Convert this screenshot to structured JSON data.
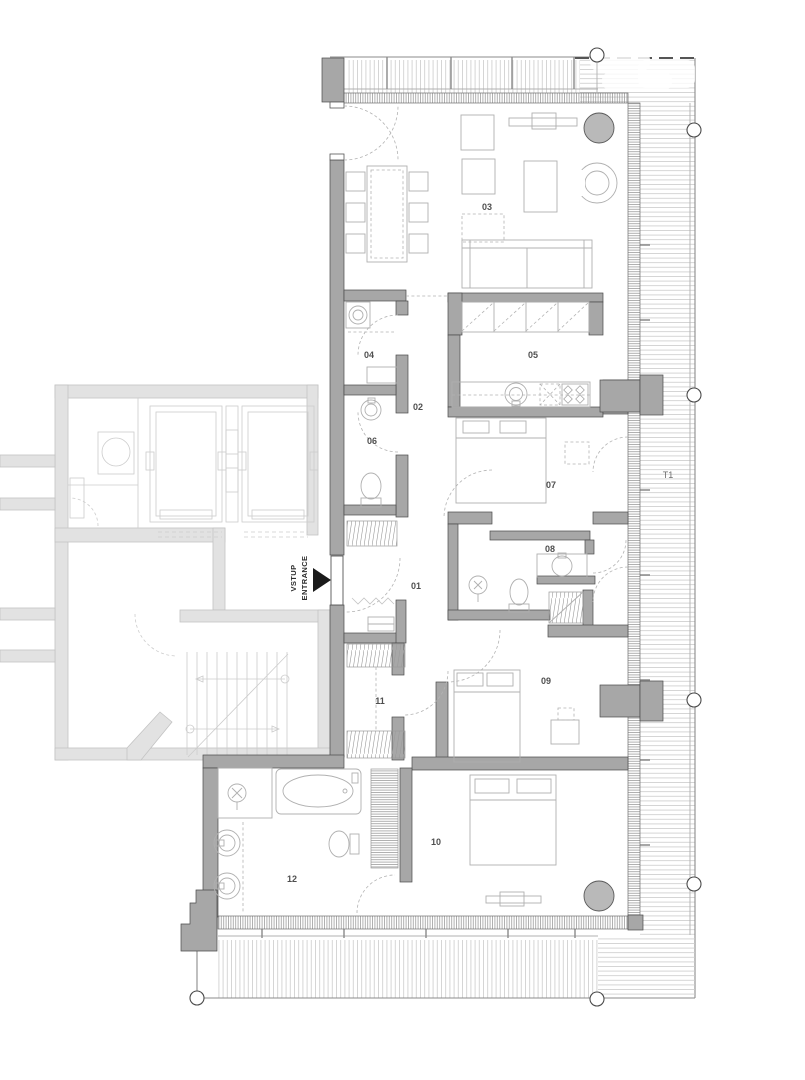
{
  "drawing": {
    "kind": "apartment floor plan",
    "unit_outline": "penthouse unit with wrap-around terrace",
    "colors": {
      "wall_fill": "#a7a7a7",
      "wall_line": "#4a4a4a",
      "context_wall_fill": "#e2e2e2",
      "furniture_line": "#b0b0b0",
      "decking_line": "#c9c9c9",
      "label_text": "#4f4f4f",
      "accent_black": "#1a1a1a"
    }
  },
  "rooms": [
    {
      "number": "01"
    },
    {
      "number": "02"
    },
    {
      "number": "03"
    },
    {
      "number": "04"
    },
    {
      "number": "05"
    },
    {
      "number": "06"
    },
    {
      "number": "07"
    },
    {
      "number": "08"
    },
    {
      "number": "09"
    },
    {
      "number": "10"
    },
    {
      "number": "11"
    },
    {
      "number": "12"
    }
  ],
  "annotations": {
    "entrance_line1": "VSTUP",
    "entrance_line2": "ENTRANCE",
    "terrace_label": "T1"
  }
}
